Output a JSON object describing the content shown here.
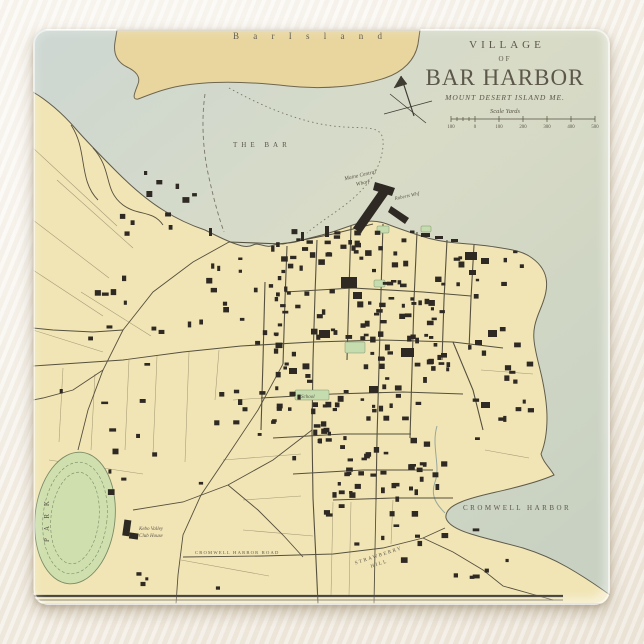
{
  "product": {
    "description": "glass coaster with antique map print",
    "background_color": "#f6f1e8",
    "map_colors": {
      "water": "#cfd8cd",
      "water_pale": "#dadcc6",
      "land": "#f1e5b5",
      "island": "#e9d69e",
      "park_green": "#cfe0ae",
      "building_ink": "#2e2a23",
      "title_ink": "#55503f"
    }
  },
  "map": {
    "title_block": {
      "line1": "VILLAGE",
      "line2": "OF",
      "line3": "BAR HARBOR",
      "line4": "MOUNT DESERT ISLAND ME.",
      "scale_label": "Scale Yards",
      "scale_ticks": [
        "100",
        "0",
        "100",
        "200",
        "300",
        "400",
        "500"
      ]
    },
    "labels": {
      "bar_island": "B a r   I s l a n d",
      "the_bar": "THE  BAR",
      "cromwell_harbor": "CROMWELL  HARBOR",
      "cromwell_harbor_road": "CROMWELL HARBOR ROAD",
      "strawberry_hill_1": "STRAWBERRY",
      "strawberry_hill_2": "HILL",
      "park": "P A R K",
      "kebo_line1": "Kebo Valley",
      "kebo_line2": "Club House",
      "school": "School",
      "maine_central_1": "Maine Central",
      "maine_central_2": "Wharf",
      "roberts_wharf": "Roberts Whf"
    }
  }
}
